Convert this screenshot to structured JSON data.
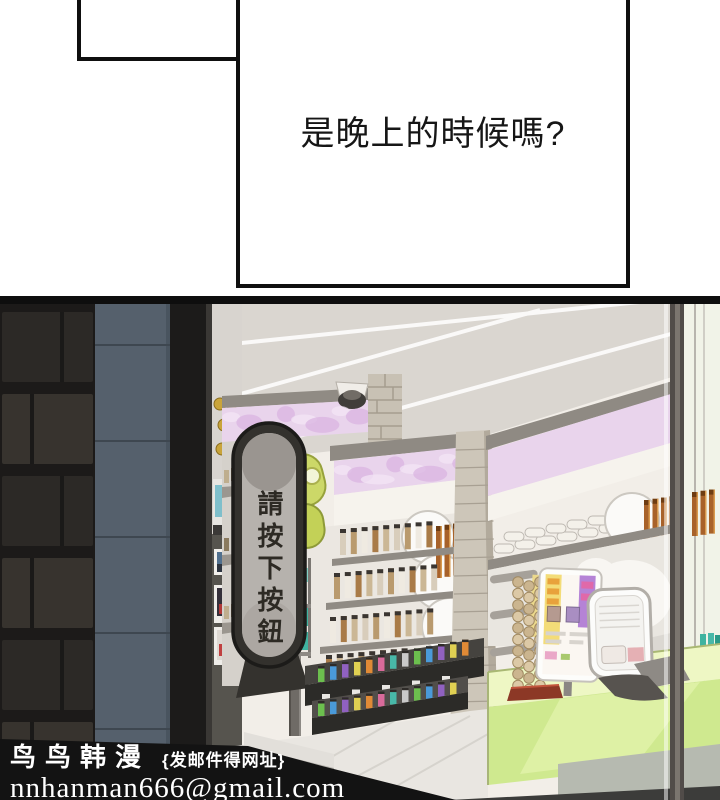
{
  "speech_bubble": {
    "text": "是晚上的時候嗎?"
  },
  "store_scene": {
    "vertical_sign_text": "請按下按鈕",
    "palette": {
      "panel_border": "#0e0e0e",
      "banner_pink": "#e9d4ec",
      "counter_green": "#cfe98f",
      "sign_plate_gray": "#b6b2ad",
      "lime_sign": "#ccd868",
      "teal_product": "#3fb3a0",
      "amber_product": "#a8622a",
      "brick_wall_dark": "#2f2c28",
      "wall_panel_blue_gray": "#55606c"
    }
  },
  "watermark": {
    "brand": "鸟鸟韩漫",
    "note": "{发邮件得网址}",
    "email": "nnhanman666@gmail.com"
  }
}
